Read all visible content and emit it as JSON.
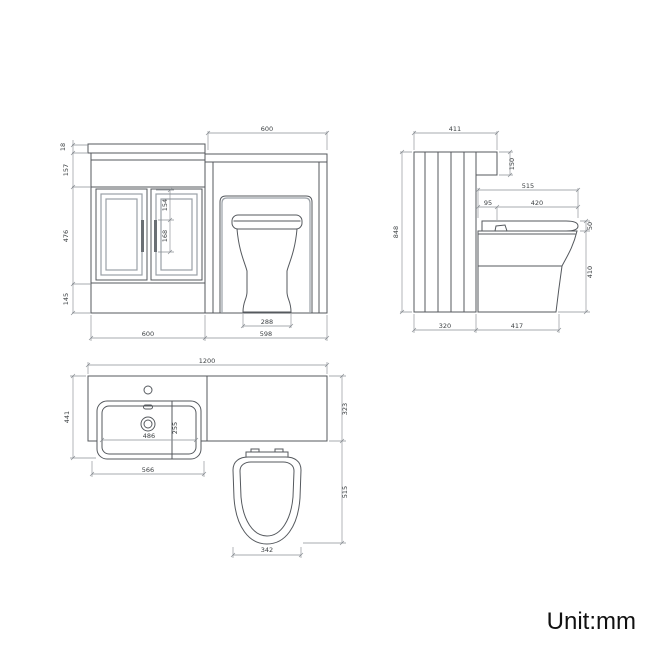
{
  "front_view": {
    "dims": {
      "wc_top_width": "600",
      "counter_thickness": "18",
      "upper_panel_height": "157",
      "door_height": "476",
      "plinth_height": "145",
      "handle_top_offset": "154",
      "handle_length": "168",
      "pan_base_width": "288",
      "vanity_width": "600",
      "wc_width": "598"
    }
  },
  "side_view": {
    "dims": {
      "worktop_depth": "411",
      "worktop_drop": "150",
      "overall_height": "848",
      "seat_total_depth": "515",
      "seat_gap": "95",
      "seat_length": "420",
      "seat_thickness": "50",
      "pan_height": "410",
      "unit_depth": "320",
      "pan_projection": "417"
    }
  },
  "plan_view": {
    "dims": {
      "overall_width": "1200",
      "vanity_depth": "441",
      "unit_depth": "323",
      "toilet_projection": "515",
      "basin_inner_width": "486",
      "basin_inner_depth": "255",
      "basin_width": "566",
      "seat_width": "342"
    }
  },
  "footer": {
    "unit_label": "Unit:mm"
  },
  "colors": {
    "outline": "#55595e",
    "secondary_line": "#9aa0a6",
    "dim_line": "#8b9095",
    "text": "#3c4043"
  }
}
